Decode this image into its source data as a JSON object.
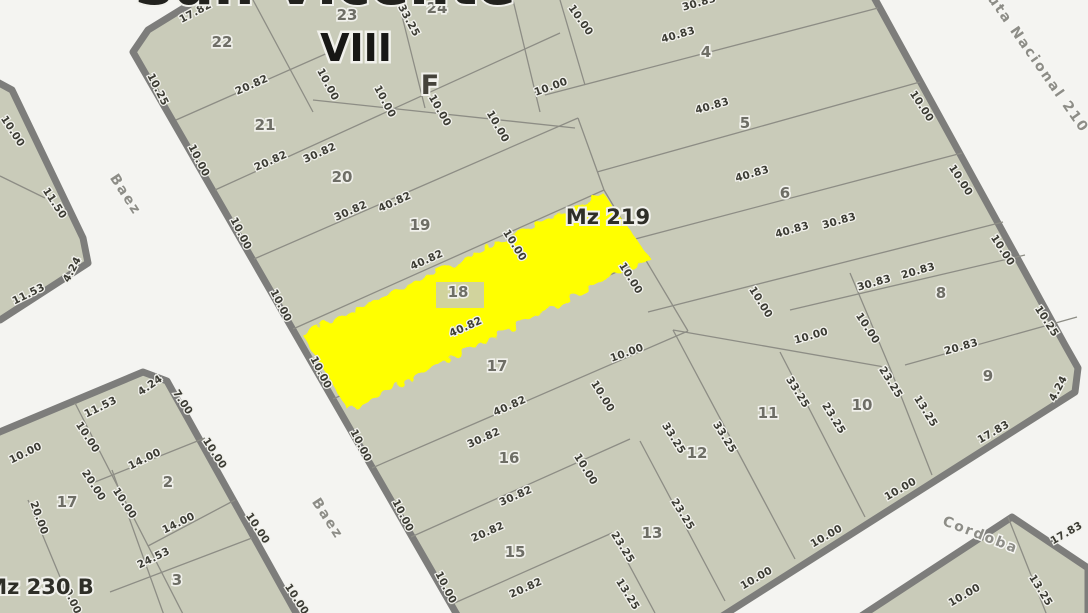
{
  "map": {
    "colors": {
      "background": "#f4f4f1",
      "parcel_fill": "#c9cbb9",
      "parcel_line": "#8d8d85",
      "block_border": "#7d7d7b",
      "highlight": "#ffff00",
      "dimension_text": "#3b3b33",
      "parcel_number_text": "#6e6e66",
      "street_text": "#8d8d87"
    },
    "zone_label": "VIII",
    "section_label": "F",
    "block_main_label": "Mz 219",
    "block_secondary_label": "Mz 230 B",
    "top_edge_clipped_text": "San Vicente",
    "highlighted_parcel": "18",
    "streets": [
      {
        "t": "Baez",
        "x": 122,
        "y": 197,
        "r": 57
      },
      {
        "t": "Baez",
        "x": 324,
        "y": 521,
        "r": 57
      },
      {
        "t": "Ruta Nacional 210",
        "x": 1031,
        "y": 61,
        "r": 55
      },
      {
        "t": "Cordoba",
        "x": 979,
        "y": 539,
        "r": 21
      }
    ],
    "parcel_numbers": [
      {
        "t": "22",
        "x": 222,
        "y": 47
      },
      {
        "t": "23",
        "x": 347,
        "y": 20
      },
      {
        "t": "24",
        "x": 437,
        "y": 13
      },
      {
        "t": "21",
        "x": 265,
        "y": 130
      },
      {
        "t": "20",
        "x": 342,
        "y": 182
      },
      {
        "t": "19",
        "x": 420,
        "y": 230
      },
      {
        "t": "18",
        "x": 458,
        "y": 297
      },
      {
        "t": "17",
        "x": 497,
        "y": 371
      },
      {
        "t": "16",
        "x": 509,
        "y": 463
      },
      {
        "t": "15",
        "x": 515,
        "y": 557
      },
      {
        "t": "4",
        "x": 706,
        "y": 57
      },
      {
        "t": "5",
        "x": 745,
        "y": 128
      },
      {
        "t": "6",
        "x": 785,
        "y": 198
      },
      {
        "t": "8",
        "x": 941,
        "y": 298
      },
      {
        "t": "9",
        "x": 988,
        "y": 381
      },
      {
        "t": "10",
        "x": 862,
        "y": 410
      },
      {
        "t": "11",
        "x": 768,
        "y": 418
      },
      {
        "t": "12",
        "x": 697,
        "y": 458
      },
      {
        "t": "13",
        "x": 652,
        "y": 538
      },
      {
        "t": "17",
        "x": 67,
        "y": 507
      },
      {
        "t": "2",
        "x": 168,
        "y": 487
      },
      {
        "t": "3",
        "x": 177,
        "y": 585
      }
    ],
    "dimensions": [
      {
        "t": "17.82",
        "x": 197,
        "y": 15,
        "r": -28
      },
      {
        "t": "10.25",
        "x": 155,
        "y": 91,
        "r": 63
      },
      {
        "t": "10.00",
        "x": 196,
        "y": 162,
        "r": 63
      },
      {
        "t": "10.00",
        "x": 238,
        "y": 235,
        "r": 63
      },
      {
        "t": "10.00",
        "x": 278,
        "y": 307,
        "r": 63
      },
      {
        "t": "10.00",
        "x": 318,
        "y": 374,
        "r": 63
      },
      {
        "t": "10.00",
        "x": 358,
        "y": 447,
        "r": 63
      },
      {
        "t": "10.00",
        "x": 400,
        "y": 517,
        "r": 63
      },
      {
        "t": "10.00",
        "x": 443,
        "y": 589,
        "r": 63
      },
      {
        "t": "20.82",
        "x": 253,
        "y": 88,
        "r": -24
      },
      {
        "t": "20.82",
        "x": 272,
        "y": 164,
        "r": -24
      },
      {
        "t": "30.82",
        "x": 321,
        "y": 156,
        "r": -24
      },
      {
        "t": "30.82",
        "x": 352,
        "y": 214,
        "r": -24
      },
      {
        "t": "40.82",
        "x": 396,
        "y": 205,
        "r": -24
      },
      {
        "t": "40.82",
        "x": 428,
        "y": 263,
        "r": -24
      },
      {
        "t": "40.82",
        "x": 467,
        "y": 330,
        "r": -24
      },
      {
        "t": "40.82",
        "x": 511,
        "y": 409,
        "r": -24
      },
      {
        "t": "30.82",
        "x": 485,
        "y": 441,
        "r": -24
      },
      {
        "t": "30.82",
        "x": 517,
        "y": 499,
        "r": -24
      },
      {
        "t": "20.82",
        "x": 489,
        "y": 535,
        "r": -24
      },
      {
        "t": "20.82",
        "x": 527,
        "y": 591,
        "r": -24
      },
      {
        "t": "33.25",
        "x": 406,
        "y": 22,
        "r": 62
      },
      {
        "t": "10.00",
        "x": 325,
        "y": 86,
        "r": 62
      },
      {
        "t": "10.00",
        "x": 382,
        "y": 103,
        "r": 62
      },
      {
        "t": "10.00",
        "x": 437,
        "y": 112,
        "r": 60
      },
      {
        "t": "10.00",
        "x": 495,
        "y": 128,
        "r": 60
      },
      {
        "t": "10.00",
        "x": 578,
        "y": 22,
        "r": 55
      },
      {
        "t": "10.00",
        "x": 552,
        "y": 90,
        "r": -20
      },
      {
        "t": "30.83",
        "x": 700,
        "y": 6,
        "r": -16
      },
      {
        "t": "40.83",
        "x": 679,
        "y": 38,
        "r": -16
      },
      {
        "t": "40.83",
        "x": 713,
        "y": 109,
        "r": -16
      },
      {
        "t": "40.83",
        "x": 753,
        "y": 177,
        "r": -16
      },
      {
        "t": "40.83",
        "x": 793,
        "y": 233,
        "r": -16
      },
      {
        "t": "30.83",
        "x": 840,
        "y": 224,
        "r": -16
      },
      {
        "t": "10.00",
        "x": 919,
        "y": 108,
        "r": 57
      },
      {
        "t": "10.00",
        "x": 958,
        "y": 182,
        "r": 57
      },
      {
        "t": "10.00",
        "x": 1000,
        "y": 252,
        "r": 57
      },
      {
        "t": "10.25",
        "x": 1044,
        "y": 323,
        "r": 57
      },
      {
        "t": "30.83",
        "x": 875,
        "y": 286,
        "r": -16
      },
      {
        "t": "20.83",
        "x": 919,
        "y": 274,
        "r": -16
      },
      {
        "t": "20.83",
        "x": 962,
        "y": 350,
        "r": -16
      },
      {
        "t": "10.00",
        "x": 865,
        "y": 330,
        "r": 57
      },
      {
        "t": "10.00",
        "x": 812,
        "y": 339,
        "r": -16
      },
      {
        "t": "4.24",
        "x": 1061,
        "y": 390,
        "r": -62
      },
      {
        "t": "17.83",
        "x": 995,
        "y": 435,
        "r": -30
      },
      {
        "t": "23.25",
        "x": 888,
        "y": 384,
        "r": 58
      },
      {
        "t": "13.25",
        "x": 923,
        "y": 413,
        "r": 58
      },
      {
        "t": "33.25",
        "x": 795,
        "y": 394,
        "r": 58
      },
      {
        "t": "23.25",
        "x": 831,
        "y": 420,
        "r": 58
      },
      {
        "t": "10.00",
        "x": 758,
        "y": 304,
        "r": 58
      },
      {
        "t": "33.25",
        "x": 722,
        "y": 439,
        "r": 58
      },
      {
        "t": "33.25",
        "x": 671,
        "y": 440,
        "r": 58
      },
      {
        "t": "23.25",
        "x": 680,
        "y": 516,
        "r": 58
      },
      {
        "t": "23.25",
        "x": 620,
        "y": 549,
        "r": 58
      },
      {
        "t": "13.25",
        "x": 625,
        "y": 596,
        "r": 58
      },
      {
        "t": "10.00",
        "x": 628,
        "y": 280,
        "r": 58
      },
      {
        "t": "10.00",
        "x": 512,
        "y": 247,
        "r": 58
      },
      {
        "t": "10.00",
        "x": 628,
        "y": 356,
        "r": -20
      },
      {
        "t": "10.00",
        "x": 600,
        "y": 398,
        "r": 58
      },
      {
        "t": "10.00",
        "x": 583,
        "y": 471,
        "r": 58
      },
      {
        "t": "10.00",
        "x": 902,
        "y": 492,
        "r": -30
      },
      {
        "t": "10.00",
        "x": 828,
        "y": 539,
        "r": -30
      },
      {
        "t": "10.00",
        "x": 758,
        "y": 581,
        "r": -30
      },
      {
        "t": "17.83",
        "x": 1068,
        "y": 536,
        "r": -30
      },
      {
        "t": "13.25",
        "x": 1038,
        "y": 592,
        "r": 58
      },
      {
        "t": "10.00",
        "x": 966,
        "y": 598,
        "r": -30
      },
      {
        "t": "10.00",
        "x": 10,
        "y": 133,
        "r": 57
      },
      {
        "t": "11.50",
        "x": 52,
        "y": 205,
        "r": 57
      },
      {
        "t": "11.53",
        "x": 30,
        "y": 297,
        "r": -26
      },
      {
        "t": "4.24",
        "x": 75,
        "y": 271,
        "r": -62
      },
      {
        "t": "11.53",
        "x": 102,
        "y": 410,
        "r": -26
      },
      {
        "t": "4.24",
        "x": 152,
        "y": 388,
        "r": -35
      },
      {
        "t": "7.00",
        "x": 180,
        "y": 404,
        "r": 57
      },
      {
        "t": "10.00",
        "x": 27,
        "y": 456,
        "r": -26
      },
      {
        "t": "10.00",
        "x": 85,
        "y": 439,
        "r": 57
      },
      {
        "t": "14.00",
        "x": 146,
        "y": 462,
        "r": -26
      },
      {
        "t": "10.00",
        "x": 212,
        "y": 455,
        "r": 57
      },
      {
        "t": "20.00",
        "x": 91,
        "y": 487,
        "r": 57
      },
      {
        "t": "20.00",
        "x": 36,
        "y": 519,
        "r": 70
      },
      {
        "t": "10.00",
        "x": 122,
        "y": 505,
        "r": 57
      },
      {
        "t": "14.00",
        "x": 180,
        "y": 526,
        "r": -26
      },
      {
        "t": "24.53",
        "x": 155,
        "y": 561,
        "r": -26
      },
      {
        "t": "10.00",
        "x": 255,
        "y": 530,
        "r": 57
      },
      {
        "t": "20.00",
        "x": 68,
        "y": 599,
        "r": 65
      },
      {
        "t": "10.00",
        "x": 294,
        "y": 601,
        "r": 57
      }
    ]
  }
}
